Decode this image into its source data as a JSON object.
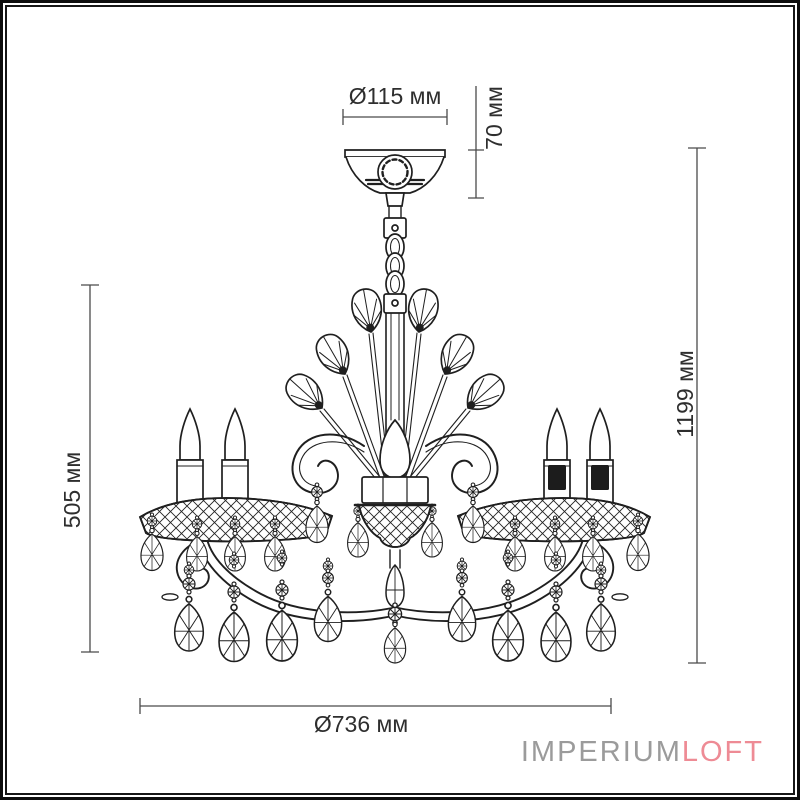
{
  "diagram": {
    "type": "chandelier dimensional drawing",
    "dimensions": {
      "canopy_diameter": "Ø115 мм",
      "canopy_height": "70 мм",
      "body_height": "505 мм",
      "total_height": "1199 мм",
      "fixture_diameter": "Ø736 мм"
    },
    "units": "мм",
    "depicted_parts": [
      "canopy",
      "chain",
      "central-stem",
      "leaf-ornaments",
      "scroll-arms",
      "candles",
      "bobeche-garlands",
      "crystal-pendants"
    ]
  },
  "branding": {
    "logo_primary": "IMPERIUM",
    "logo_accent": "LOFT",
    "logo_primary_color": "#9b9b9b",
    "logo_accent_color": "#ee8b95"
  },
  "colors": {
    "background": "#ffffff",
    "drawing_line": "#1f1f1f",
    "dimension_line": "#4a4a4a",
    "dimension_text": "#2e2e2e",
    "frame": "#111111"
  }
}
